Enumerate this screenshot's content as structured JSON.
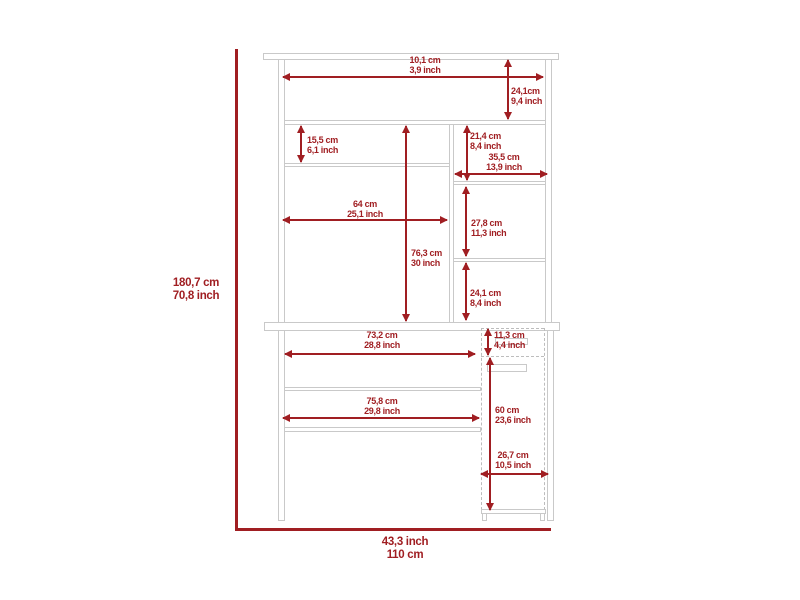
{
  "diagram": {
    "type": "furniture-dimension-diagram",
    "subject": "desk-with-hutch",
    "colors": {
      "dimension_red": "#a01e22",
      "furniture_line_gray": "#c9c9c9",
      "background": "#ffffff"
    },
    "dims": {
      "overall_height": {
        "line1": "180,7 cm",
        "line2": "70,8 inch"
      },
      "overall_width": {
        "line1": "43,3 inch",
        "line2": "110 cm"
      },
      "top_shelf_width": {
        "line1": "10,1 cm",
        "line2": "3,9 inch"
      },
      "top_shelf_height": {
        "line1": "24,1cm",
        "line2": "9,4 inch"
      },
      "left_cubby_height": {
        "line1": "15,5 cm",
        "line2": "6,1 inch"
      },
      "right_cubby_height": {
        "line1": "21,4 cm",
        "line2": "8,4 inch"
      },
      "right_section_width": {
        "line1": "35,5 cm",
        "line2": "13,9 inch"
      },
      "hutch_interior_width": {
        "line1": "64 cm",
        "line2": "25,1 inch"
      },
      "hutch_interior_height": {
        "line1": "76,3 cm",
        "line2": "30 inch"
      },
      "right_middle_shelf_height": {
        "line1": "27,8 cm",
        "line2": "11,3 inch"
      },
      "right_lower_shelf_height": {
        "line1": "24,1 cm",
        "line2": "8,4 inch"
      },
      "desk_opening_width_upper": {
        "line1": "73,2 cm",
        "line2": "28,8 inch"
      },
      "drawer_height": {
        "line1": "11,3 cm",
        "line2": "4,4 inch"
      },
      "desk_opening_width_lower": {
        "line1": "75,8 cm",
        "line2": "29,8 inch"
      },
      "cabinet_height": {
        "line1": "60 cm",
        "line2": "23,6 inch"
      },
      "cabinet_width": {
        "line1": "26,7 cm",
        "line2": "10,5 inch"
      }
    }
  }
}
